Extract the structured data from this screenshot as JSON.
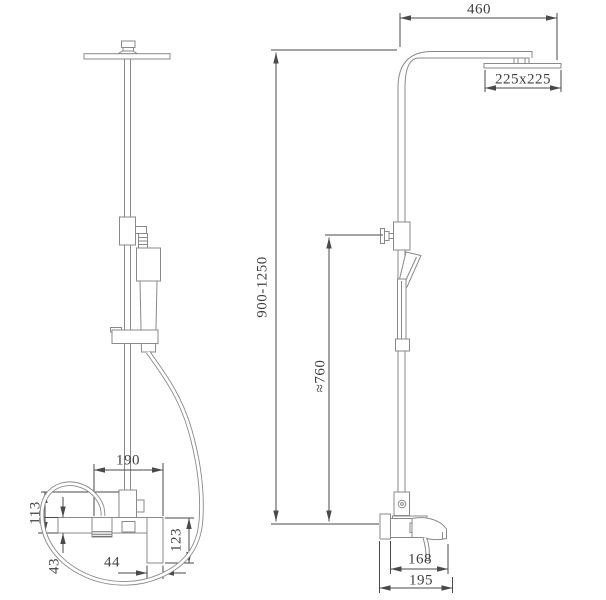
{
  "drawing": {
    "background_color": "#ffffff",
    "part_line_color": "#8a8a8a",
    "dimension_line_color": "#4a4a4a",
    "text_color": "#3f3f3f"
  },
  "dims": {
    "arm_reach": "460",
    "head_size": "225x225",
    "column_height_range": "900-1250",
    "approx_hose_height": "≈760",
    "mixer_width": "190",
    "escutcheon_to_body": "113",
    "body_height": "43",
    "spout_front_width": "44",
    "spout_drop": "123",
    "spout_reach": "168",
    "overall_depth": "195"
  }
}
